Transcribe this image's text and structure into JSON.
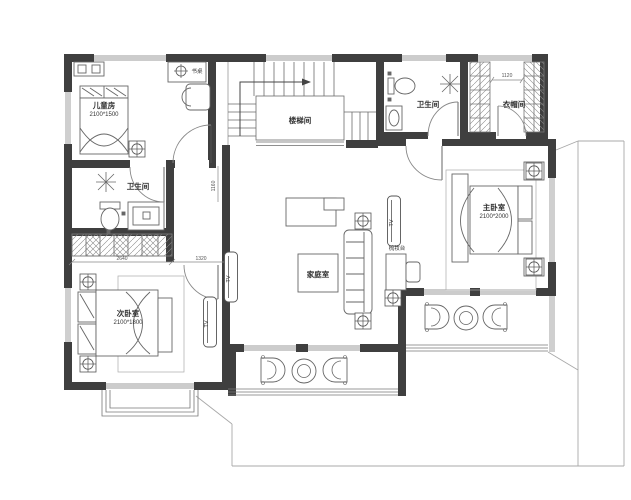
{
  "plan": {
    "rooms": {
      "children": {
        "label": "儿童房",
        "size": "2100*1500"
      },
      "bath_left": {
        "label": "卫生间"
      },
      "second_bedroom": {
        "label": "次卧室",
        "size": "2100*1800"
      },
      "stairwell": {
        "label": "楼梯间"
      },
      "family": {
        "label": "家庭室"
      },
      "bath_right": {
        "label": "卫生间"
      },
      "cloakroom": {
        "label": "衣帽间"
      },
      "master": {
        "label": "主卧室",
        "size": "2100*2000"
      }
    },
    "furniture": {
      "desk": "书桌",
      "dressing_table": "梳妆台",
      "tv": "TV"
    },
    "dimensions": {
      "closet_width": "2640",
      "entry_width": "1320",
      "corridor_width": "1160",
      "cloakroom_width": "1120"
    },
    "colors": {
      "wall": "#3f3f3f",
      "line": "#6b6b6b",
      "thin": "#a8a8a8",
      "background": "#ffffff"
    }
  }
}
